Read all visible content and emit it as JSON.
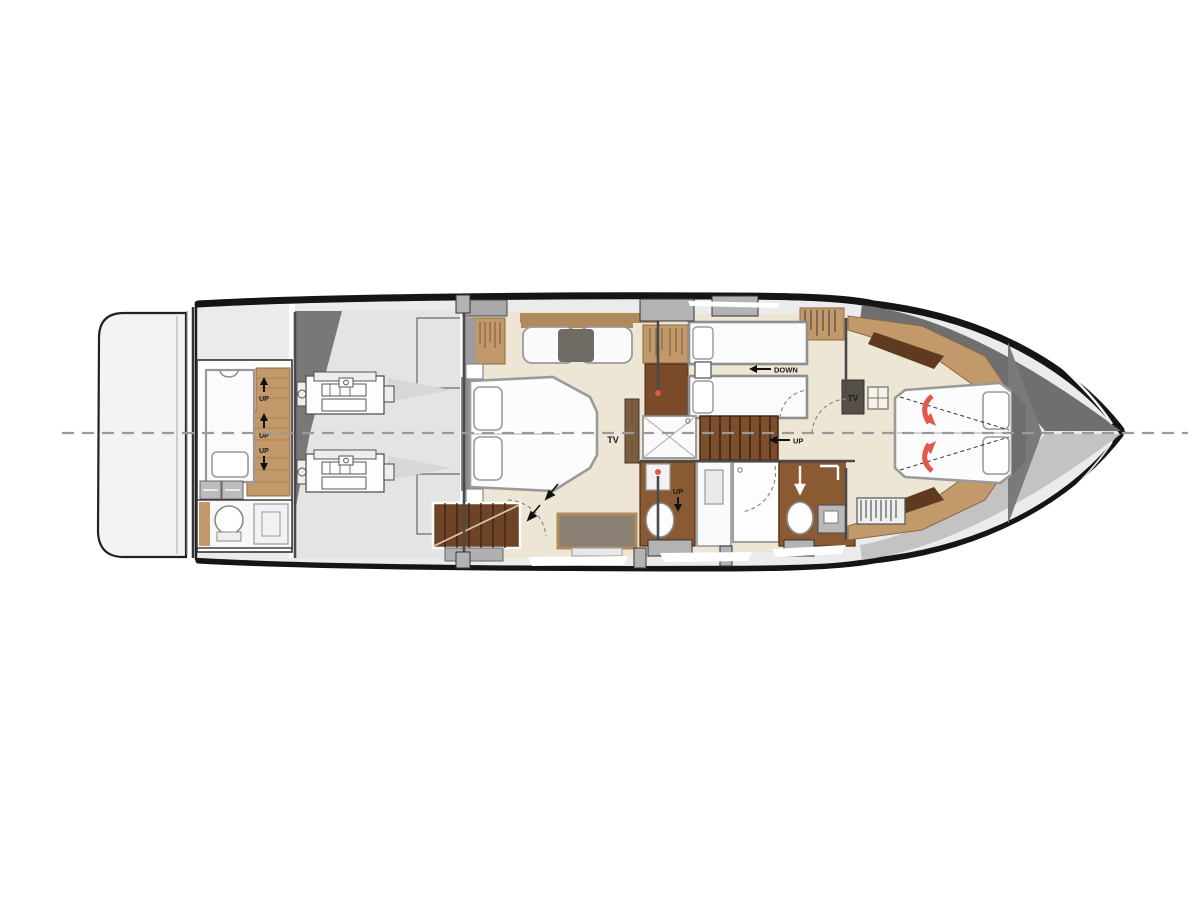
{
  "plan": {
    "labels": {
      "up": "UP",
      "down": "DOWN",
      "tv": "TV"
    },
    "colors": {
      "accent_red": "#e4574d",
      "wood_light": "#c2996b",
      "wood_dark": "#6b4226",
      "floor_cream": "#ede6d4",
      "hull_dark": "#161616",
      "deck_gray": "#9c9c9c"
    }
  }
}
